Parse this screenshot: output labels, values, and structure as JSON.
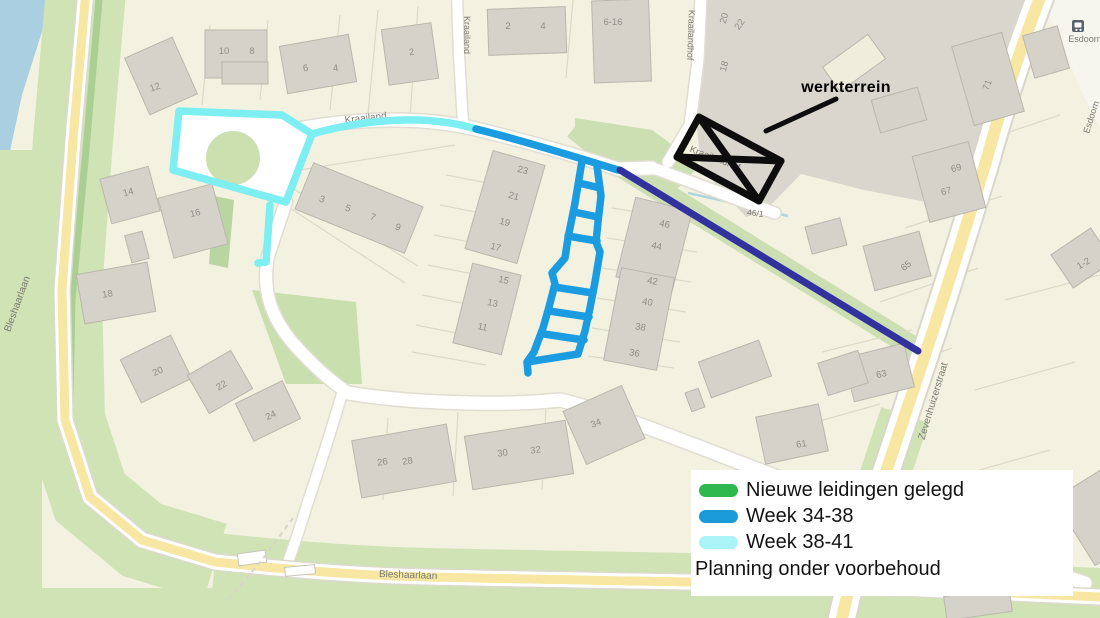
{
  "legend": {
    "items": [
      {
        "label": "Nieuwe leidingen gelegd",
        "color": "#2eb84d"
      },
      {
        "label": "Week 34-38",
        "color": "#1b9ad8"
      },
      {
        "label": "Week 38-41",
        "color": "#aaf3f6"
      }
    ],
    "note": "Planning onder voorbehoud"
  },
  "work_area": {
    "label": "werkterrein"
  },
  "colors": {
    "route_week_34_38": "#1b9ce1",
    "route_week_38_41": "#7deef1",
    "route_dark": "#32319d",
    "route_done_green": "#2eb84d",
    "work_area_black": "#0d0d0d"
  },
  "map": {
    "street_labels": [
      [
        "Kraailand",
        366,
        121,
        -6,
        10
      ],
      [
        "Kraailand",
        464,
        35,
        90,
        9
      ],
      [
        "Kraailandhof",
        688,
        35,
        92,
        9
      ],
      [
        "Kraailandhof",
        714,
        161,
        21,
        9.5
      ],
      [
        "Bleshaarlaan",
        20,
        305,
        -70,
        10
      ],
      [
        "Bleshaarlaan",
        408,
        578,
        2,
        10
      ],
      [
        "Zevenhuizerstraat",
        936,
        402,
        -73,
        10
      ],
      [
        "Esdoorn",
        1085,
        42,
        0,
        9
      ],
      [
        "Esdoorn",
        1094,
        118,
        -72,
        9
      ],
      [
        "46/1",
        755,
        216,
        8,
        8.5
      ]
    ],
    "house_numbers": [
      [
        "12",
        156,
        90,
        -20
      ],
      [
        "10",
        224,
        54,
        0
      ],
      [
        "8",
        252,
        54,
        0
      ],
      [
        "6",
        306,
        71,
        -8
      ],
      [
        "4",
        336,
        71,
        -8
      ],
      [
        "2",
        412,
        55,
        -8
      ],
      [
        "2",
        508,
        29,
        0
      ],
      [
        "4",
        543,
        29,
        0
      ],
      [
        "6-16",
        613,
        25,
        0
      ],
      [
        "14",
        129,
        195,
        -15
      ],
      [
        "16",
        196,
        216,
        -15
      ],
      [
        "18",
        108,
        297,
        -10
      ],
      [
        "3",
        321,
        202,
        20
      ],
      [
        "5",
        347,
        211,
        20
      ],
      [
        "7",
        372,
        220,
        20
      ],
      [
        "9",
        397,
        230,
        20
      ],
      [
        "23",
        522,
        173,
        15
      ],
      [
        "21",
        513,
        199,
        15
      ],
      [
        "19",
        504,
        225,
        15
      ],
      [
        "17",
        495,
        250,
        15
      ],
      [
        "15",
        503,
        283,
        12
      ],
      [
        "13",
        492,
        306,
        12
      ],
      [
        "11",
        482,
        330,
        12
      ],
      [
        "46",
        664,
        227,
        12
      ],
      [
        "44",
        656,
        249,
        12
      ],
      [
        "42",
        652,
        284,
        10
      ],
      [
        "40",
        647,
        305,
        10
      ],
      [
        "38",
        640,
        330,
        10
      ],
      [
        "36",
        634,
        356,
        10
      ],
      [
        "20",
        159,
        374,
        -25
      ],
      [
        "22",
        223,
        388,
        -30
      ],
      [
        "24",
        272,
        418,
        -25
      ],
      [
        "26",
        383,
        465,
        -10
      ],
      [
        "28",
        408,
        464,
        -10
      ],
      [
        "30",
        503,
        456,
        -8
      ],
      [
        "32",
        536,
        453,
        -8
      ],
      [
        "34",
        597,
        426,
        -22
      ],
      [
        "61",
        802,
        447,
        -10
      ],
      [
        "63",
        882,
        377,
        -12
      ],
      [
        "65",
        908,
        268,
        -40
      ],
      [
        "67",
        947,
        194,
        -15
      ],
      [
        "69",
        957,
        171,
        -15
      ],
      [
        "71",
        990,
        86,
        -70
      ],
      [
        "1-2",
        1085,
        266,
        -30
      ],
      [
        "20",
        727,
        19,
        -75
      ],
      [
        "22",
        742,
        26,
        -55
      ],
      [
        "18",
        727,
        67,
        -75
      ]
    ],
    "buildings": [
      [
        135,
        45,
        52,
        62,
        -24
      ],
      [
        205,
        30,
        62,
        48,
        0
      ],
      [
        222,
        62,
        46,
        22,
        0
      ],
      [
        283,
        40,
        70,
        48,
        -10
      ],
      [
        385,
        26,
        50,
        56,
        -8
      ],
      [
        488,
        8,
        78,
        46,
        -2
      ],
      [
        593,
        0,
        57,
        82,
        -2
      ],
      [
        105,
        172,
        50,
        46,
        -15
      ],
      [
        165,
        190,
        56,
        62,
        -15
      ],
      [
        80,
        268,
        72,
        50,
        -10
      ],
      [
        128,
        233,
        18,
        28,
        -15
      ],
      [
        300,
        183,
        118,
        50,
        22
      ],
      [
        478,
        156,
        54,
        102,
        16
      ],
      [
        462,
        268,
        50,
        82,
        14
      ],
      [
        625,
        203,
        58,
        82,
        14
      ],
      [
        612,
        272,
        54,
        94,
        11
      ],
      [
        128,
        345,
        56,
        48,
        -26
      ],
      [
        195,
        360,
        50,
        44,
        -30
      ],
      [
        242,
        390,
        52,
        42,
        -26
      ],
      [
        356,
        432,
        96,
        58,
        -10
      ],
      [
        468,
        428,
        102,
        54,
        -9
      ],
      [
        572,
        396,
        64,
        58,
        -24
      ],
      [
        760,
        410,
        64,
        48,
        -12
      ],
      [
        848,
        350,
        62,
        45,
        -14
      ],
      [
        868,
        238,
        58,
        46,
        -15
      ],
      [
        920,
        148,
        58,
        68,
        -15
      ],
      [
        962,
        38,
        52,
        82,
        -16
      ],
      [
        1058,
        238,
        48,
        40,
        -34
      ],
      [
        703,
        350,
        64,
        38,
        -20
      ],
      [
        822,
        356,
        42,
        34,
        -18
      ],
      [
        688,
        390,
        14,
        20,
        -20
      ],
      [
        808,
        222,
        36,
        28,
        -15
      ],
      [
        875,
        93,
        48,
        34,
        -16
      ],
      [
        1028,
        30,
        36,
        44,
        -16
      ],
      [
        1070,
        478,
        58,
        78,
        -32
      ],
      [
        945,
        592,
        66,
        24,
        -8
      ],
      [
        826,
        48,
        56,
        30,
        -36,
        "#efeddc"
      ]
    ]
  }
}
